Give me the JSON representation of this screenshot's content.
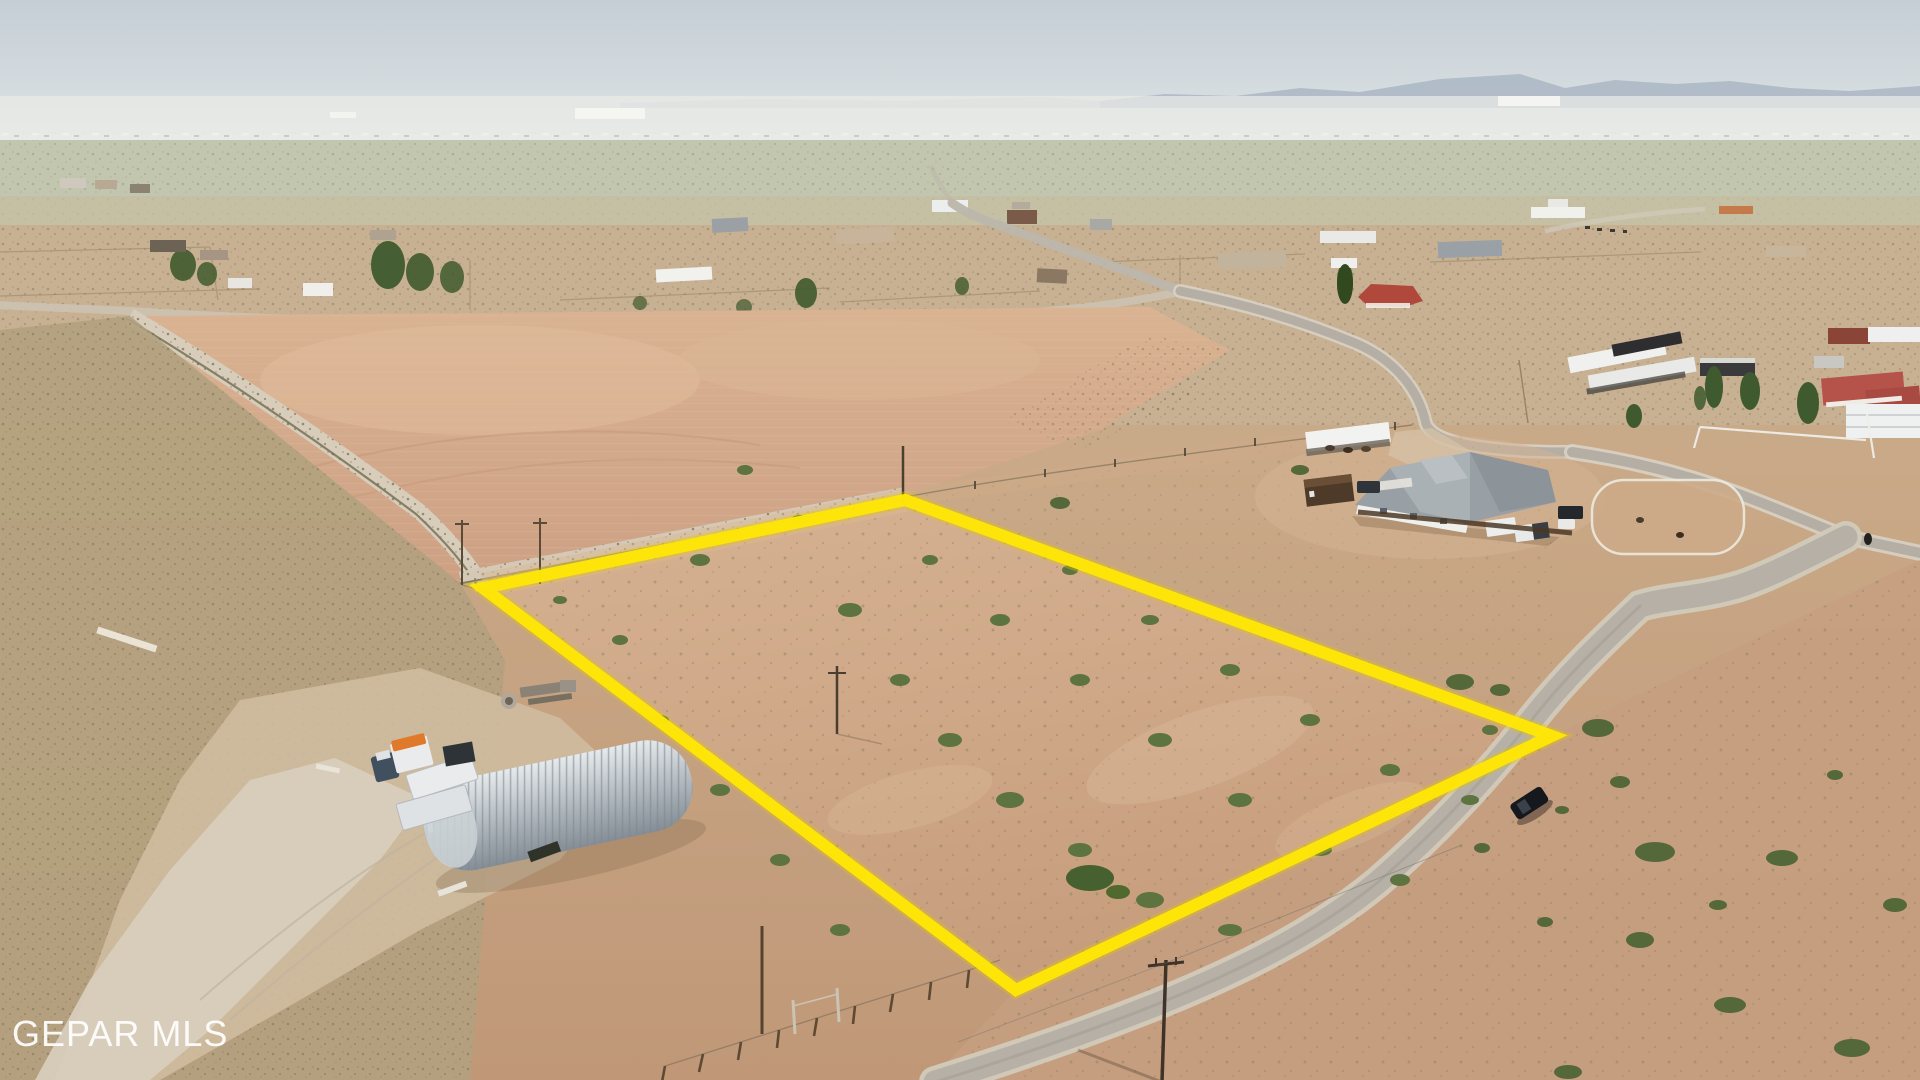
{
  "meta": {
    "description": "Aerial drone photo of a desert land parcel outlined in yellow, rural subdivision, quonset hut and trucks at lower left, house compound at right, paved road lower right with black car"
  },
  "watermark": {
    "text": "GEPAR MLS",
    "color": "rgba(255,255,255,0.92)"
  },
  "boundary": {
    "points": "905,500 483,588 1016,990 1552,736",
    "color": "#FFE606",
    "glow_color": "#E2C900",
    "stroke_width": "12",
    "glow_width": "17"
  },
  "palette": {
    "sky_top": "#c5ced6",
    "sky_bottom": "#e4e9ea",
    "mountains": "#a6b2c1",
    "valley": "#c2c6ae",
    "town_dirt": "#c8b093",
    "field_pink": "#d5ad8d",
    "lot_dirt": "#cfa985",
    "west_desert": "#b2a17e",
    "road_paved": "#b6b0a6",
    "road_shoulder": "#d4ccbd",
    "hut_metal": "#b9c0c6",
    "bush_green": "#5d7340"
  }
}
